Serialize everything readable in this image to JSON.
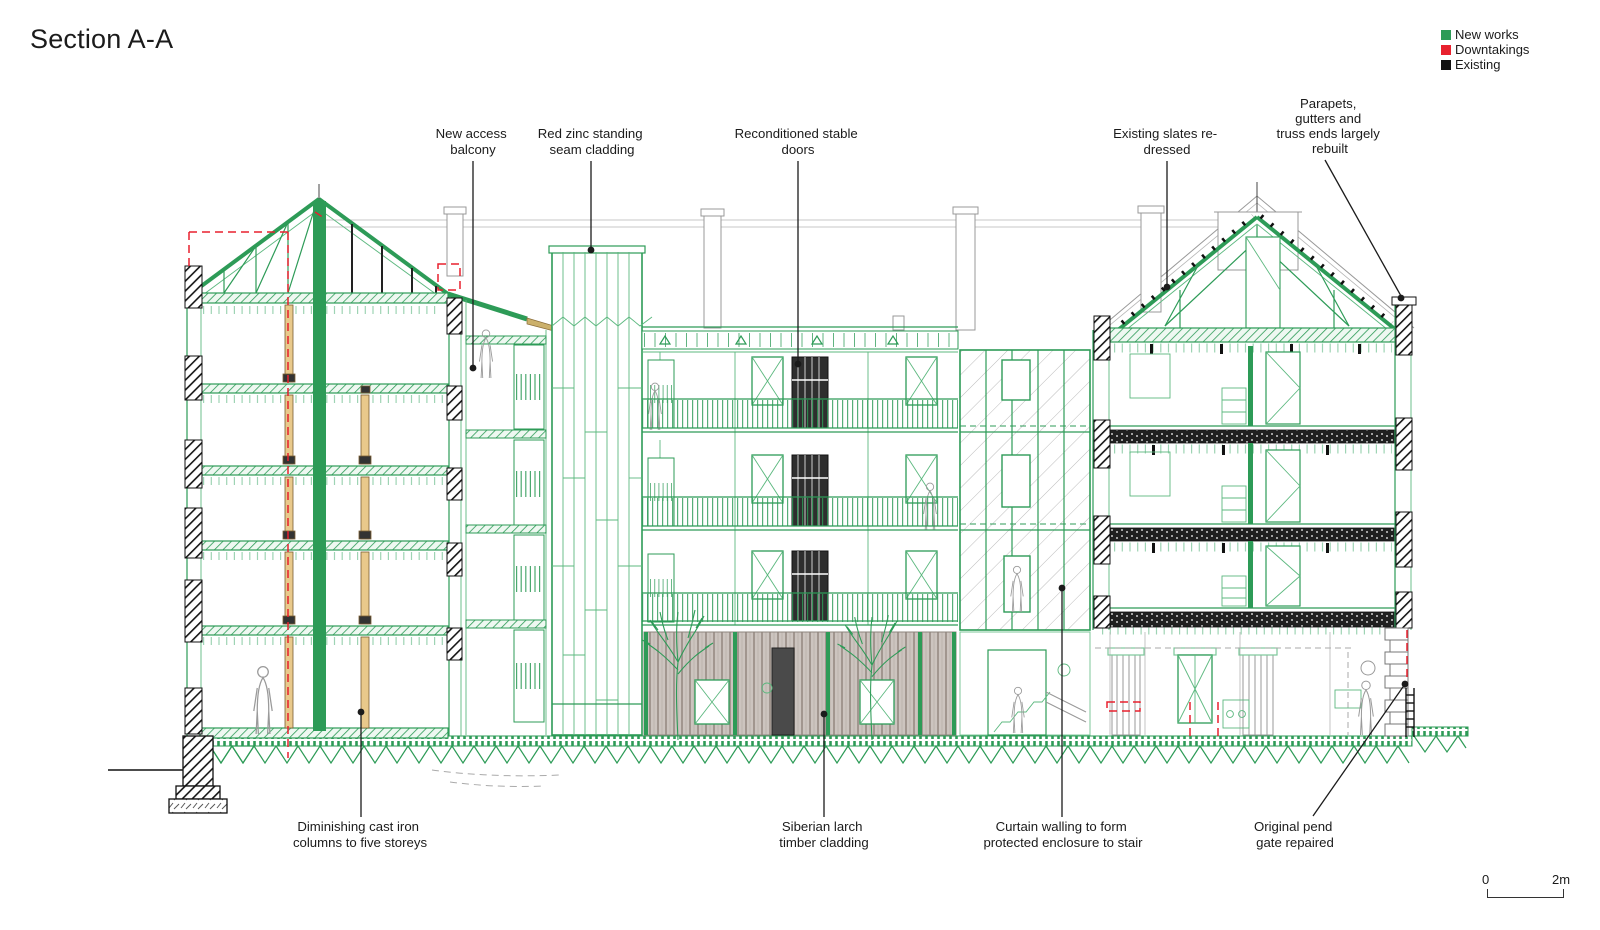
{
  "title": "Section A-A",
  "legend": {
    "items": [
      {
        "label": "New works",
        "color": "#2d9b57"
      },
      {
        "label": "Downtakings",
        "color": "#e8212e"
      },
      {
        "label": "Existing",
        "color": "#111111"
      }
    ]
  },
  "annotations": {
    "new_access_balcony": {
      "lines": [
        "New access",
        "balcony"
      ]
    },
    "red_zinc": {
      "lines": [
        "Red zinc standing",
        "seam cladding"
      ]
    },
    "stable_doors": {
      "lines": [
        "Reconditioned stable",
        "doors"
      ]
    },
    "existing_slates": {
      "lines": [
        "Existing slates re-",
        "dressed"
      ]
    },
    "parapets": {
      "lines": [
        "Parapets,",
        "gutters and",
        "truss ends largely",
        "rebuilt"
      ]
    },
    "cast_iron": {
      "lines": [
        "Diminishing cast iron",
        "columns to five storeys"
      ]
    },
    "siberian_larch": {
      "lines": [
        "Siberian larch",
        "timber cladding"
      ]
    },
    "curtain_walling": {
      "lines": [
        "Curtain walling to form",
        "protected enclosure to stair"
      ]
    },
    "pend_gate": {
      "lines": [
        "Original pend",
        "gate repaired"
      ]
    }
  },
  "scale_bar": {
    "zero": "0",
    "two_m": "2m"
  },
  "colors": {
    "new_works": "#2d9b57",
    "downtakings": "#e8212e",
    "existing": "#111111",
    "cast_iron_column": "#e9c98b",
    "timber_cladding": "#ccc4bf"
  }
}
